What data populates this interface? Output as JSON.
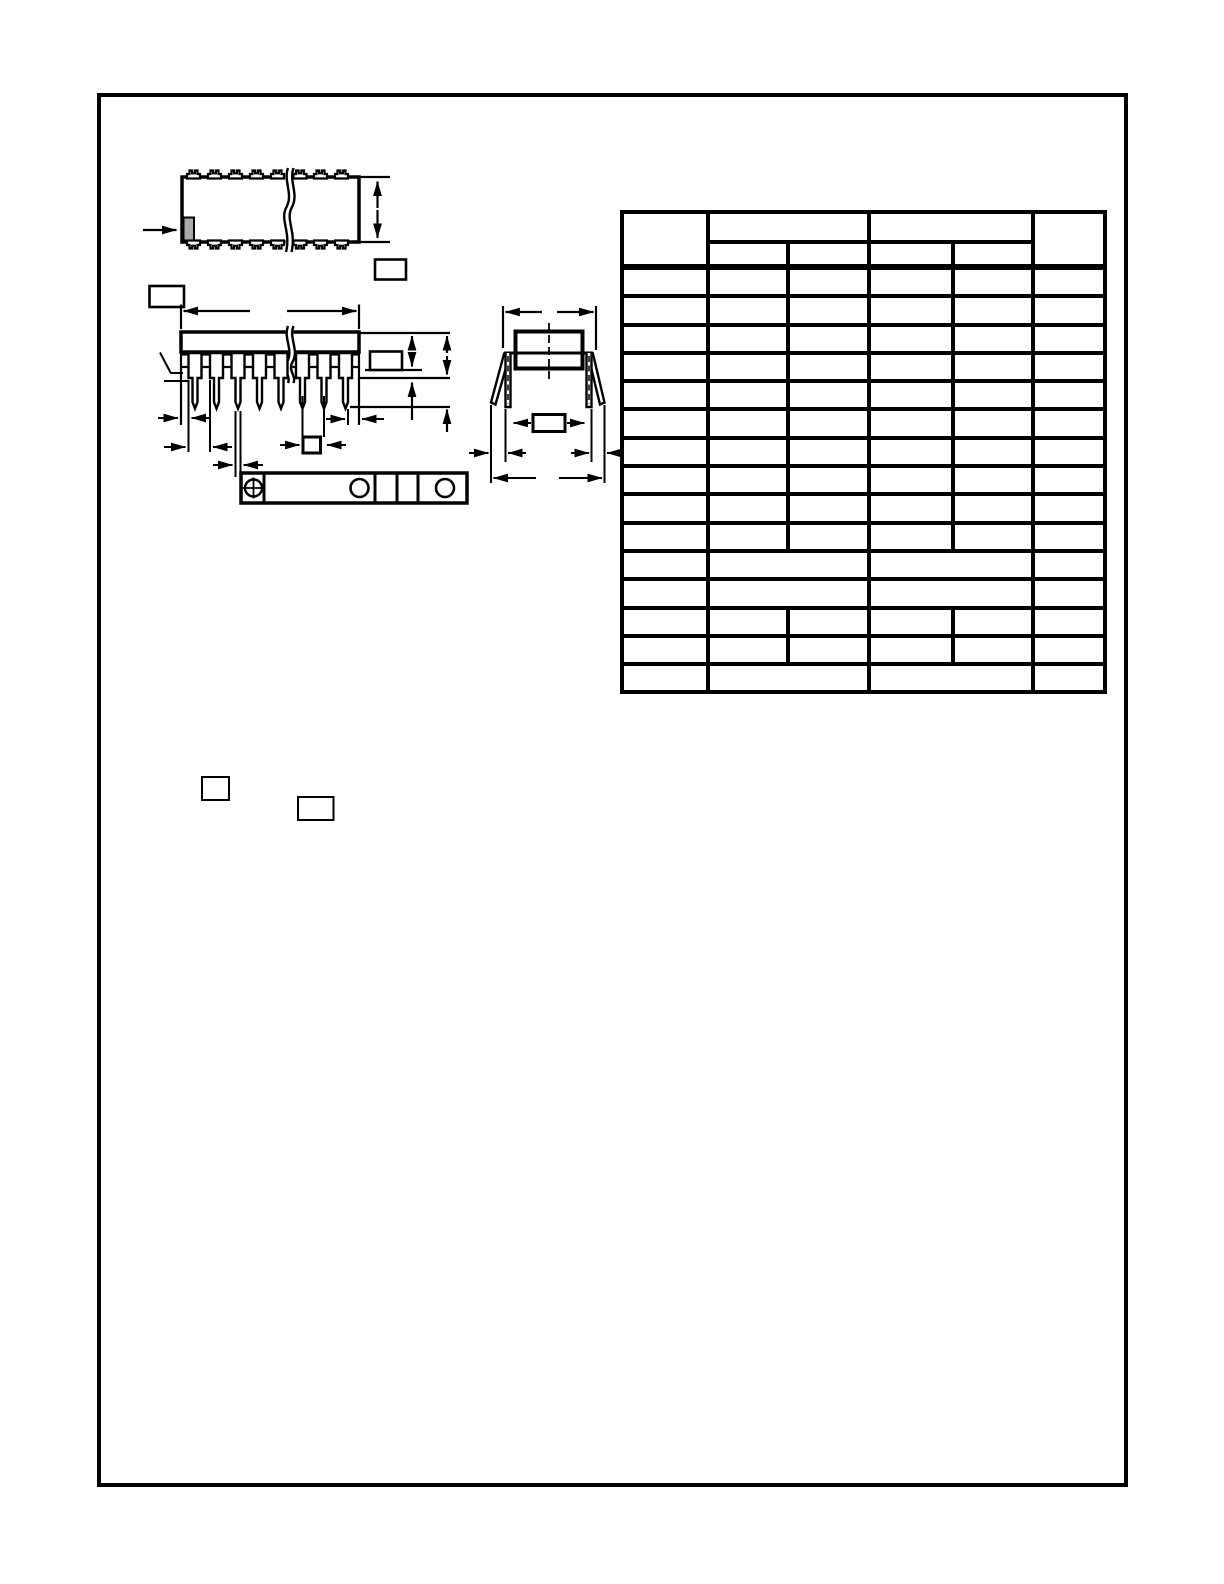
{
  "colors": {
    "background": "#ffffff",
    "line": "#000000",
    "pin1_marker": "#a9a9a9"
  },
  "drawing": {
    "views": {
      "top_view_label": "",
      "side_view_label": "",
      "end_view_label": ""
    },
    "dimension_label_boxes": [
      "",
      "",
      "",
      "",
      "",
      ""
    ],
    "note_reference_boxes": [
      "",
      ""
    ]
  },
  "table": {
    "header": {
      "col_dim": "",
      "group_left": "",
      "group_left_sub": [
        "",
        ""
      ],
      "group_right": "",
      "group_right_sub": [
        "",
        ""
      ],
      "col_notes": ""
    },
    "body_rows": [
      {
        "type": "normal",
        "cells": [
          "",
          "",
          "",
          "",
          "",
          ""
        ]
      },
      {
        "type": "normal",
        "cells": [
          "",
          "",
          "",
          "",
          "",
          ""
        ]
      },
      {
        "type": "normal",
        "cells": [
          "",
          "",
          "",
          "",
          "",
          ""
        ]
      },
      {
        "type": "normal",
        "cells": [
          "",
          "",
          "",
          "",
          "",
          ""
        ]
      },
      {
        "type": "normal",
        "cells": [
          "",
          "",
          "",
          "",
          "",
          ""
        ]
      },
      {
        "type": "normal",
        "cells": [
          "",
          "",
          "",
          "",
          "",
          ""
        ]
      },
      {
        "type": "normal",
        "cells": [
          "",
          "",
          "",
          "",
          "",
          ""
        ]
      },
      {
        "type": "normal",
        "cells": [
          "",
          "",
          "",
          "",
          "",
          ""
        ]
      },
      {
        "type": "normal",
        "cells": [
          "",
          "",
          "",
          "",
          "",
          ""
        ]
      },
      {
        "type": "normal",
        "cells": [
          "",
          "",
          "",
          "",
          "",
          ""
        ]
      },
      {
        "type": "merged",
        "cells": [
          "",
          "",
          "",
          ""
        ]
      },
      {
        "type": "merged",
        "cells": [
          "",
          "",
          "",
          ""
        ]
      },
      {
        "type": "normal",
        "cells": [
          "",
          "",
          "",
          "",
          "",
          ""
        ]
      },
      {
        "type": "normal",
        "cells": [
          "",
          "",
          "",
          "",
          "",
          ""
        ]
      },
      {
        "type": "merged",
        "cells": [
          "",
          "",
          "",
          ""
        ]
      }
    ]
  }
}
